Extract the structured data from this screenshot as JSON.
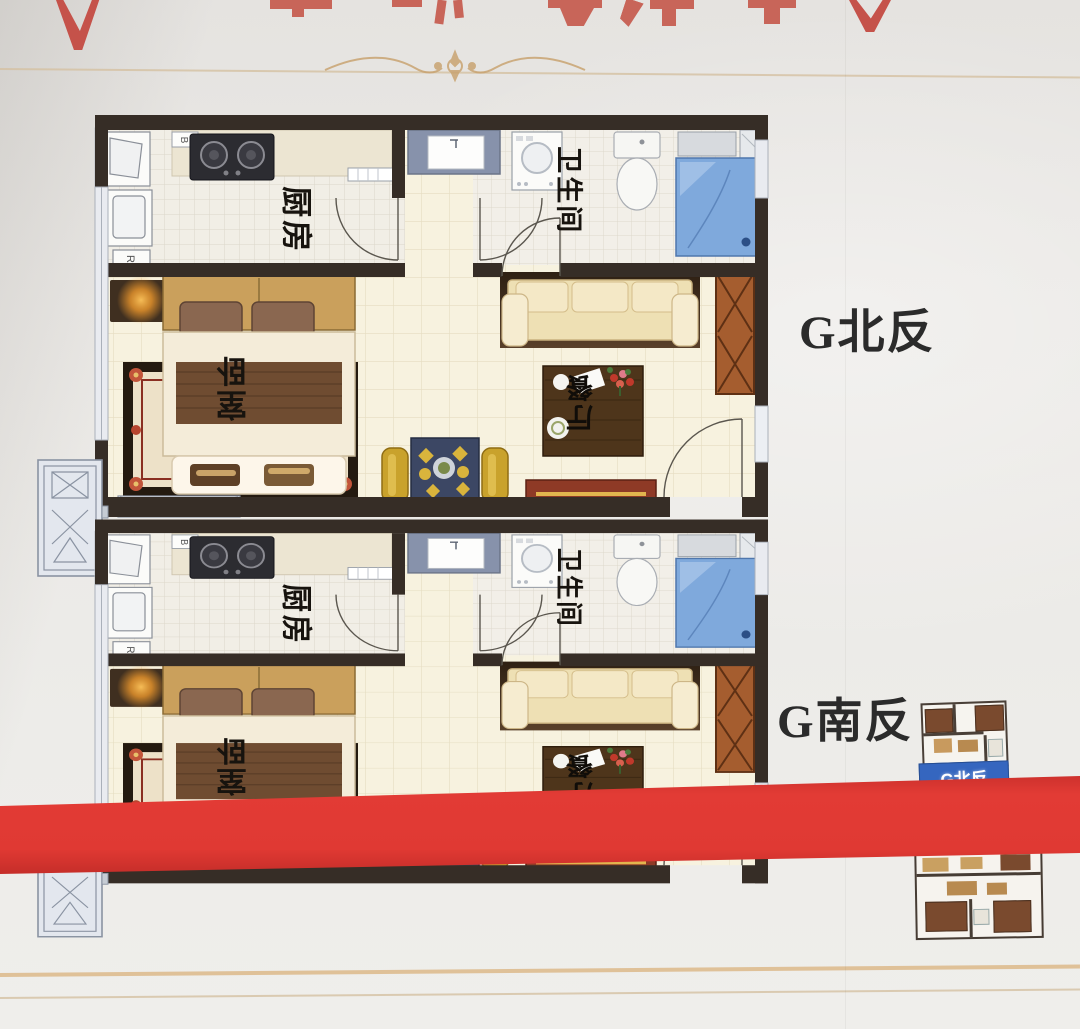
{
  "poster": {
    "rooms": {
      "kitchen": "厨房",
      "bathroom": "卫生间",
      "bedroom": "卧室",
      "dining": "餐厅"
    },
    "units": [
      {
        "caption": "G北反"
      },
      {
        "caption": "G南反"
      }
    ],
    "appliance_marks": {
      "boiler": "B",
      "washer": "R"
    },
    "thumbnails": [
      {
        "banner": "G北反"
      }
    ],
    "colors": {
      "ribbon_red": "#d93331",
      "caption_text": "#2b2b2b",
      "banner_blue": "#3566bf",
      "wall": "#362d26"
    }
  }
}
